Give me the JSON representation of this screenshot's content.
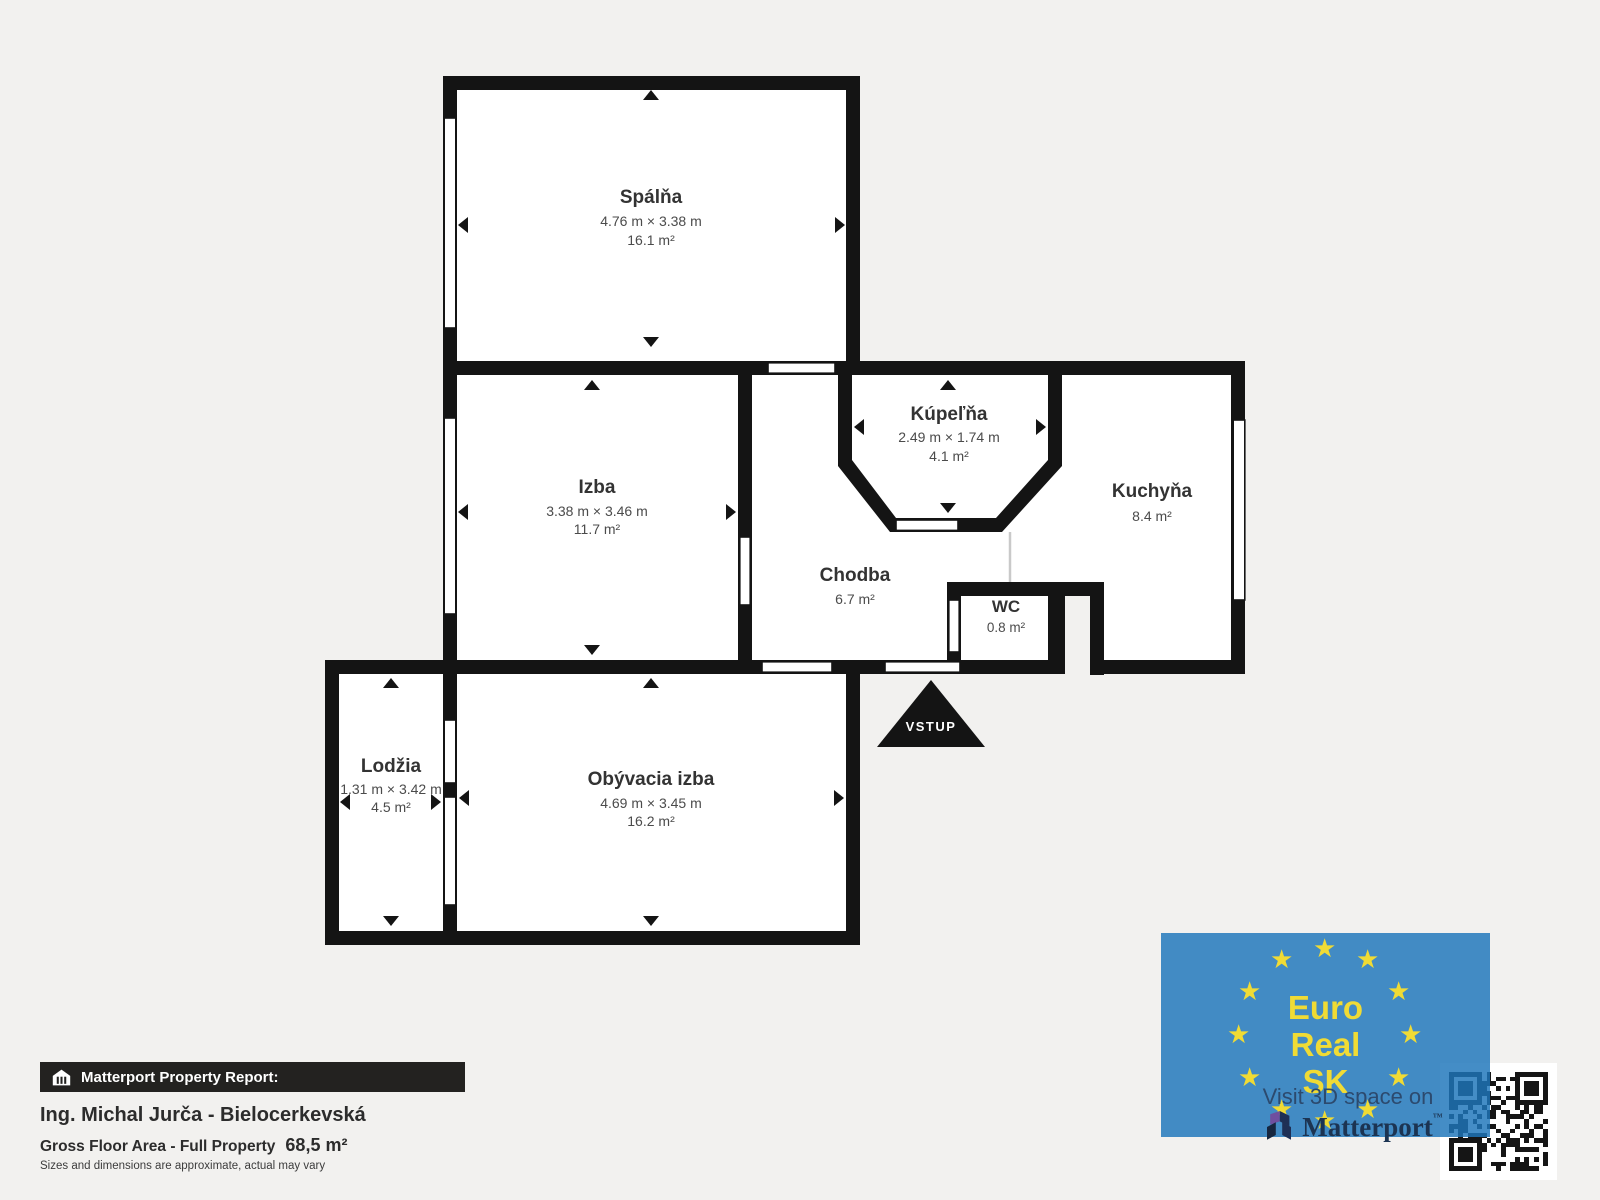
{
  "floorplan": {
    "rooms": {
      "spalna": {
        "name": "Spálňa",
        "dims": "4.76 m × 3.38 m",
        "area": "16.1 m²"
      },
      "izba": {
        "name": "Izba",
        "dims": "3.38 m × 3.46 m",
        "area": "11.7 m²"
      },
      "kupelna": {
        "name": "Kúpeľňa",
        "dims": "2.49 m × 1.74 m",
        "area": "4.1 m²"
      },
      "kuchyna": {
        "name": "Kuchyňa",
        "area": "8.4 m²"
      },
      "chodba": {
        "name": "Chodba",
        "area": "6.7 m²"
      },
      "wc": {
        "name": "WC",
        "area": "0.8 m²"
      },
      "lodzia": {
        "name": "Lodžia",
        "dims": "1.31 m × 3.42 m",
        "area": "4.5 m²"
      },
      "obyvacia": {
        "name": "Obývacia izba",
        "dims": "4.69 m × 3.45 m",
        "area": "16.2 m²"
      }
    },
    "entrance_label": "VSTUP"
  },
  "report": {
    "bar_title": "Matterport Property Report:",
    "property_name": "Ing. Michal Jurča - Bielocerkevská",
    "gfa_label": "Gross Floor Area - Full Property",
    "gfa_value": "68,5 m²",
    "disclaimer": "Sizes and dimensions are approximate, actual may vary"
  },
  "logo": {
    "lines": [
      "Euro",
      "Real",
      "SK"
    ],
    "star_glyph": "★",
    "visit_text": "Visit 3D space on",
    "matterport_text": "Matterport",
    "matterport_tm": "™",
    "colors": {
      "blue": "#4a8fc4",
      "yellow": "#F0DB35",
      "navy": "#1c3452",
      "wall": "#141414",
      "background": "#f2f1ef"
    }
  }
}
